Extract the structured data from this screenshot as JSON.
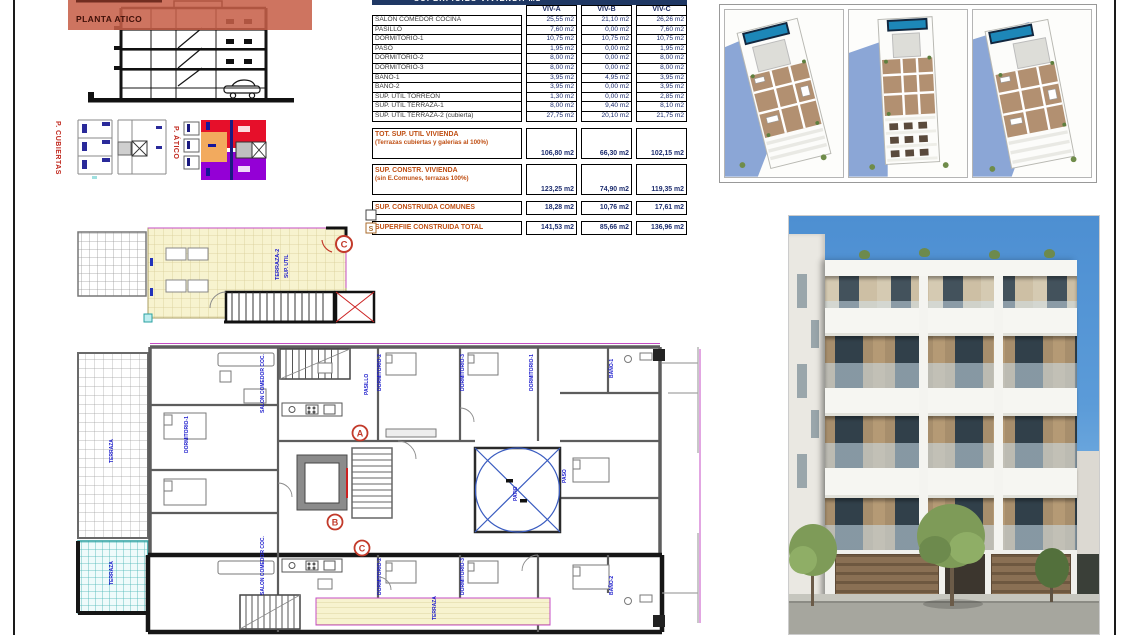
{
  "section_panel": {
    "overlay_label": "PLANTA ATICO"
  },
  "key_plans": {
    "cubiertas_label": "P. CUBIERTAS",
    "atico_label": "P. ÁTICO"
  },
  "area_table": {
    "title": "SUPERFICIES VIVIENDA M2",
    "columns": [
      "VIV-A",
      "VIV-B",
      "VIV-C"
    ],
    "rows": [
      {
        "label": "SALON COMEDOR COCINA",
        "values": [
          "25,55 m2",
          "21,10 m2",
          "26,26 m2"
        ]
      },
      {
        "label": "PASILLO",
        "values": [
          "7,60 m2",
          "0,00 m2",
          "7,60 m2"
        ]
      },
      {
        "label": "DORMITORIO-1",
        "values": [
          "10,75 m2",
          "10,75 m2",
          "10,75 m2"
        ]
      },
      {
        "label": "PASO",
        "values": [
          "1,95 m2",
          "0,00 m2",
          "1,95 m2"
        ]
      },
      {
        "label": "DORMITORIO-2",
        "values": [
          "8,00 m2",
          "0,00 m2",
          "8,00 m2"
        ]
      },
      {
        "label": "DORMITORIO-3",
        "values": [
          "8,00 m2",
          "0,00 m2",
          "8,00 m2"
        ]
      },
      {
        "label": "BAÑO-1",
        "values": [
          "3,95 m2",
          "4,95 m2",
          "3,95 m2"
        ]
      },
      {
        "label": "BAÑO-2",
        "values": [
          "3,95 m2",
          "0,00 m2",
          "3,95 m2"
        ]
      },
      {
        "label": "SUP. ÚTIL TORREON",
        "values": [
          "1,30 m2",
          "0,00 m2",
          "2,85 m2"
        ]
      },
      {
        "label": "SUP. ÚTIL TERRAZA-1",
        "values": [
          "8,00 m2",
          "9,40 m2",
          "8,10 m2"
        ]
      },
      {
        "label": "SUP. ÚTIL TERRAZA-2 (cubierta)",
        "values": [
          "27,75 m2",
          "20,10 m2",
          "21,75 m2"
        ]
      }
    ],
    "summary": [
      {
        "label": "TOT. SUP. UTIL VIVIENDA",
        "sublabel": "(Terrazas cubiertas y galerias al 100%)",
        "values": [
          "106,80 m2",
          "66,30 m2",
          "102,15 m2"
        ]
      },
      {
        "label": "SUP. CONSTR. VIVIENDA",
        "sublabel": "(sin E.Comunes, terrazas 100%)",
        "values": [
          "123,25 m2",
          "74,90 m2",
          "119,35 m2"
        ]
      },
      {
        "label": "SUP. CONSTRUIDA COMUNES",
        "sublabel": "",
        "values": [
          "18,28 m2",
          "10,76 m2",
          "17,61 m2"
        ]
      },
      {
        "label": "SUPERFIIE CONSTRUIDA TOTAL",
        "sublabel": "",
        "values": [
          "141,53 m2",
          "85,66 m2",
          "136,96 m2"
        ]
      }
    ]
  },
  "markers": {
    "a": "A",
    "b": "B",
    "c": "C",
    "roof_c": "C"
  },
  "roof_plan": {
    "labels": [
      "TERRAZA-2",
      "SUP. UTIL"
    ],
    "legend_letter": "S"
  },
  "main_plan": {
    "labels": [
      "TERRAZA",
      "TERRAZA",
      "SALON COMEDOR COC.",
      "DORMITORIO-1",
      "PASILLO",
      "DORMITORIO-2",
      "DORMITORIO-3",
      "DORMITORIO-1",
      "BAÑO-1",
      "PATIO",
      "SALON COMEDOR COC.",
      "DORMITORIO-2",
      "DORMITORIO-3",
      "BAÑO-2",
      "TERRAZA",
      "PASO"
    ]
  },
  "colors": {
    "accent_red": "#c23a2a",
    "navy": "#1c2c6e",
    "orange": "#bf4e12",
    "band_navy": "#1f3864",
    "overlay_salmon": "#c75f48",
    "atico_red": "#e60f2a",
    "atico_purple": "#9400d6",
    "atico_orange": "#f2aa5e",
    "plan_blue": "#1a1acc",
    "terrace_yellow": "#f7f3cf",
    "pool_blue": "#1d87b8"
  }
}
